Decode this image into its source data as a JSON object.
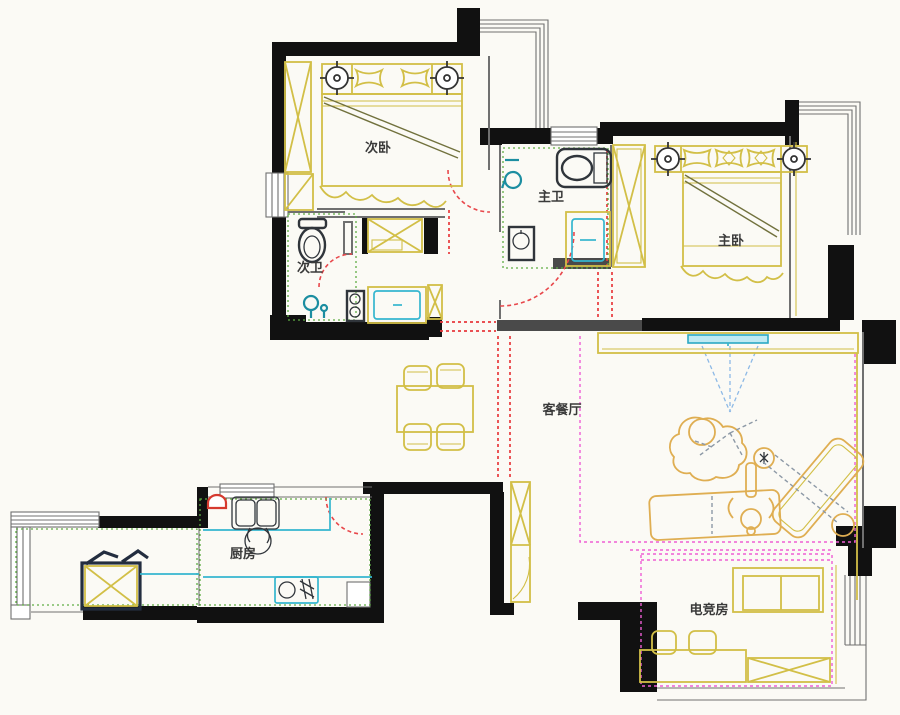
{
  "meta": {
    "title": "Apartment floor plan"
  },
  "rooms": [
    {
      "id": "secondary-bedroom",
      "label": "次卧"
    },
    {
      "id": "secondary-bathroom",
      "label": "次卫"
    },
    {
      "id": "master-bathroom",
      "label": "主卫"
    },
    {
      "id": "master-bedroom",
      "label": "主卧"
    },
    {
      "id": "living-dining",
      "label": "客餐厅"
    },
    {
      "id": "kitchen",
      "label": "厨房"
    },
    {
      "id": "gaming-room",
      "label": "电竞房"
    }
  ],
  "colors": {
    "paper": "#fbfaf5",
    "wall": "#111111",
    "wallgray": "#4a4a4a",
    "thinwall": "#707070",
    "furniture": "#d2bf47",
    "furniture2": "#dfae52",
    "fixture": "#30353b",
    "appliance": "#35b6cf",
    "shower": "#1c8ea1",
    "door": "#e8474b",
    "dashred": "#e8393c",
    "dashpink": "#ef5ed4",
    "dashgreen": "#5fae44",
    "dashblue": "#8db9e6"
  }
}
